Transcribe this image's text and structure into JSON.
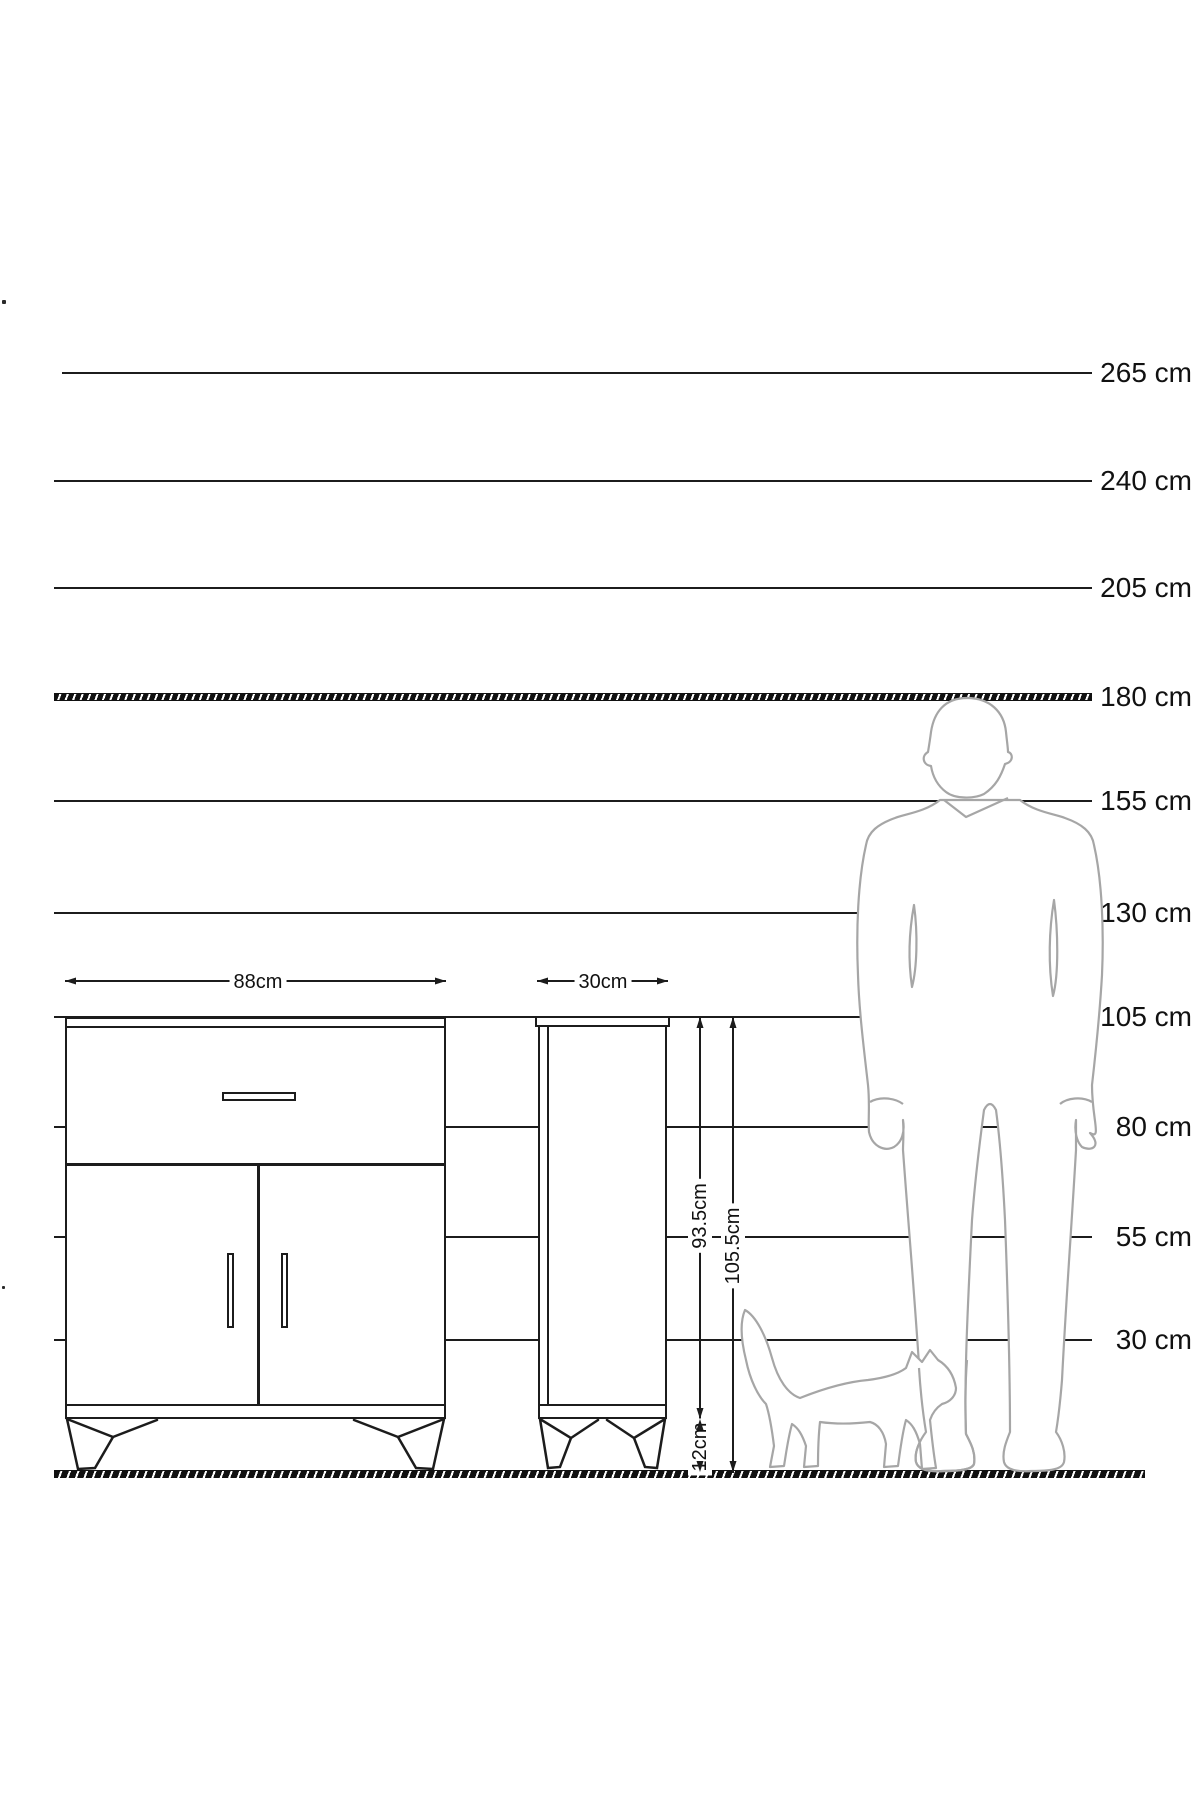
{
  "diagram": {
    "title": "furniture-height-scale-diagram",
    "unit": "cm",
    "colors": {
      "line": "#1c1c1c",
      "silhouette_outline": "#a6a6a6",
      "background": "#ffffff"
    },
    "scale": {
      "items": [
        {
          "label": "265 cm",
          "value": 265,
          "y": 373,
          "x1": 62,
          "x2": 1092,
          "style": "solid"
        },
        {
          "label": "240 cm",
          "value": 240,
          "y": 481,
          "x1": 54,
          "x2": 1092,
          "style": "solid"
        },
        {
          "label": "205 cm",
          "value": 205,
          "y": 588,
          "x1": 54,
          "x2": 1092,
          "style": "solid"
        },
        {
          "label": "180 cm",
          "value": 180,
          "y": 697,
          "x1": 54,
          "x2": 1092,
          "style": "hatched"
        },
        {
          "label": "155 cm",
          "value": 155,
          "y": 801,
          "x1": 54,
          "x2": 1092,
          "style": "solid"
        },
        {
          "label": "130 cm",
          "value": 130,
          "y": 913,
          "x1": 54,
          "x2": 1092,
          "style": "solid"
        },
        {
          "label": "105 cm",
          "value": 105,
          "y": 1017,
          "x1": 54,
          "x2": 1092,
          "style": "solid"
        },
        {
          "label": "80 cm",
          "value": 80,
          "y": 1127,
          "x1": 54,
          "x2": 1092,
          "style": "solid"
        },
        {
          "label": "55 cm",
          "value": 55,
          "y": 1237,
          "x1": 54,
          "x2": 1092,
          "style": "solid"
        },
        {
          "label": "30 cm",
          "value": 30,
          "y": 1340,
          "x1": 54,
          "x2": 1092,
          "style": "solid"
        }
      ],
      "label_left": 1042,
      "label_width": 150
    },
    "ground": {
      "y": 1470,
      "x1": 54,
      "x2": 1145
    },
    "dimensions": {
      "front_width": {
        "label": "88cm",
        "value_cm": 88
      },
      "side_depth": {
        "label": "30cm",
        "value_cm": 30
      },
      "body_height": {
        "label": "93.5cm",
        "value_cm": 93.5
      },
      "total_height": {
        "label": "105.5cm",
        "value_cm": 105.5
      },
      "leg_height": {
        "label": "12cm",
        "value_cm": 12
      }
    },
    "figures": {
      "man": {
        "name": "man-silhouette",
        "reference_height_cm": 180
      },
      "cat": {
        "name": "cat-silhouette"
      }
    },
    "views": {
      "front": {
        "name": "cabinet-front-view",
        "features": [
          "drawer",
          "two-doors",
          "four-splayed-legs",
          "drawer-handle",
          "two-door-handles"
        ]
      },
      "side": {
        "name": "cabinet-side-view",
        "features": [
          "top-cap",
          "front-edge-line",
          "splayed-legs"
        ]
      }
    }
  }
}
